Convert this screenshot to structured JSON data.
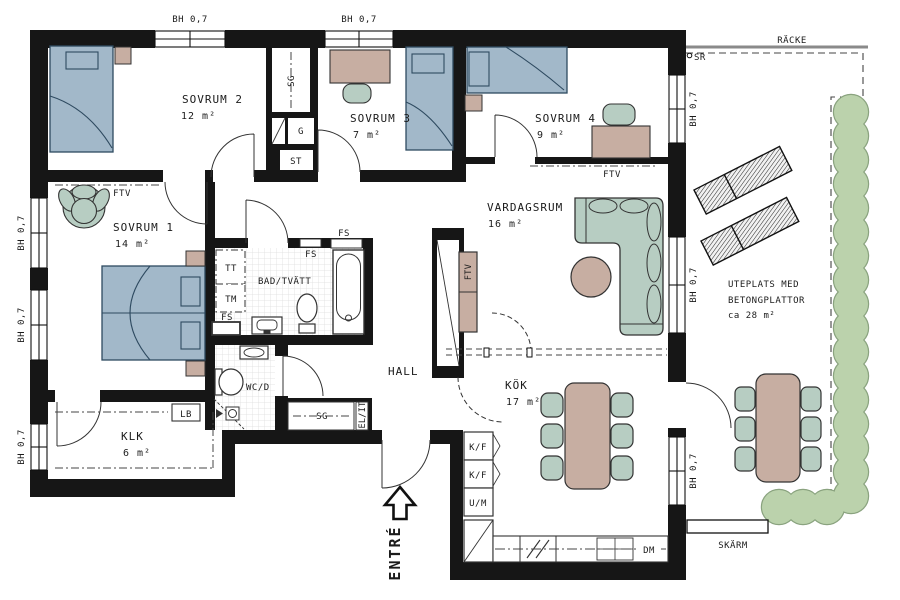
{
  "plan_labels": {
    "window_height": "BH 0,7",
    "racke": "RÄCKE",
    "skarm": "SKÄRM",
    "sr": "SR",
    "ftv": "FTV",
    "sg": "SG",
    "g": "G",
    "st": "ST",
    "tt": "TT",
    "tm": "TM",
    "fs": "FS",
    "lb": "LB",
    "el_it": "EL/IT",
    "kf": "K/F",
    "um": "U/M",
    "dm": "DM"
  },
  "rooms": {
    "sovrum1": {
      "name": "SOVRUM 1",
      "area": "14 m²"
    },
    "sovrum2": {
      "name": "SOVRUM 2",
      "area": "12 m²"
    },
    "sovrum3": {
      "name": "SOVRUM 3",
      "area": "7 m²"
    },
    "sovrum4": {
      "name": "SOVRUM 4",
      "area": "9 m²"
    },
    "vardagsrum": {
      "name": "VARDAGSRUM",
      "area": "16 m²"
    },
    "kok": {
      "name": "KÖK",
      "area": "17 m²"
    },
    "hall": {
      "name": "HALL"
    },
    "bad_tvatt": {
      "name": "BAD/TVÄTT"
    },
    "wc_d": {
      "name": "WC/D"
    },
    "klk": {
      "name": "KLK",
      "area": "6 m²"
    },
    "uteplats": {
      "line1": "UTEPLATS MED",
      "line2": "BETONGPLATTOR",
      "area": "ca 28 m²"
    },
    "entre": {
      "name": "ENTRÉ"
    }
  },
  "colors": {
    "wall": "#161616",
    "bed": "#a2b8c9",
    "wood": "#c7aea2",
    "upholstery": "#b7cdc2",
    "hedge": "#bbd2ac",
    "tile_line": "#dcdcdc"
  }
}
